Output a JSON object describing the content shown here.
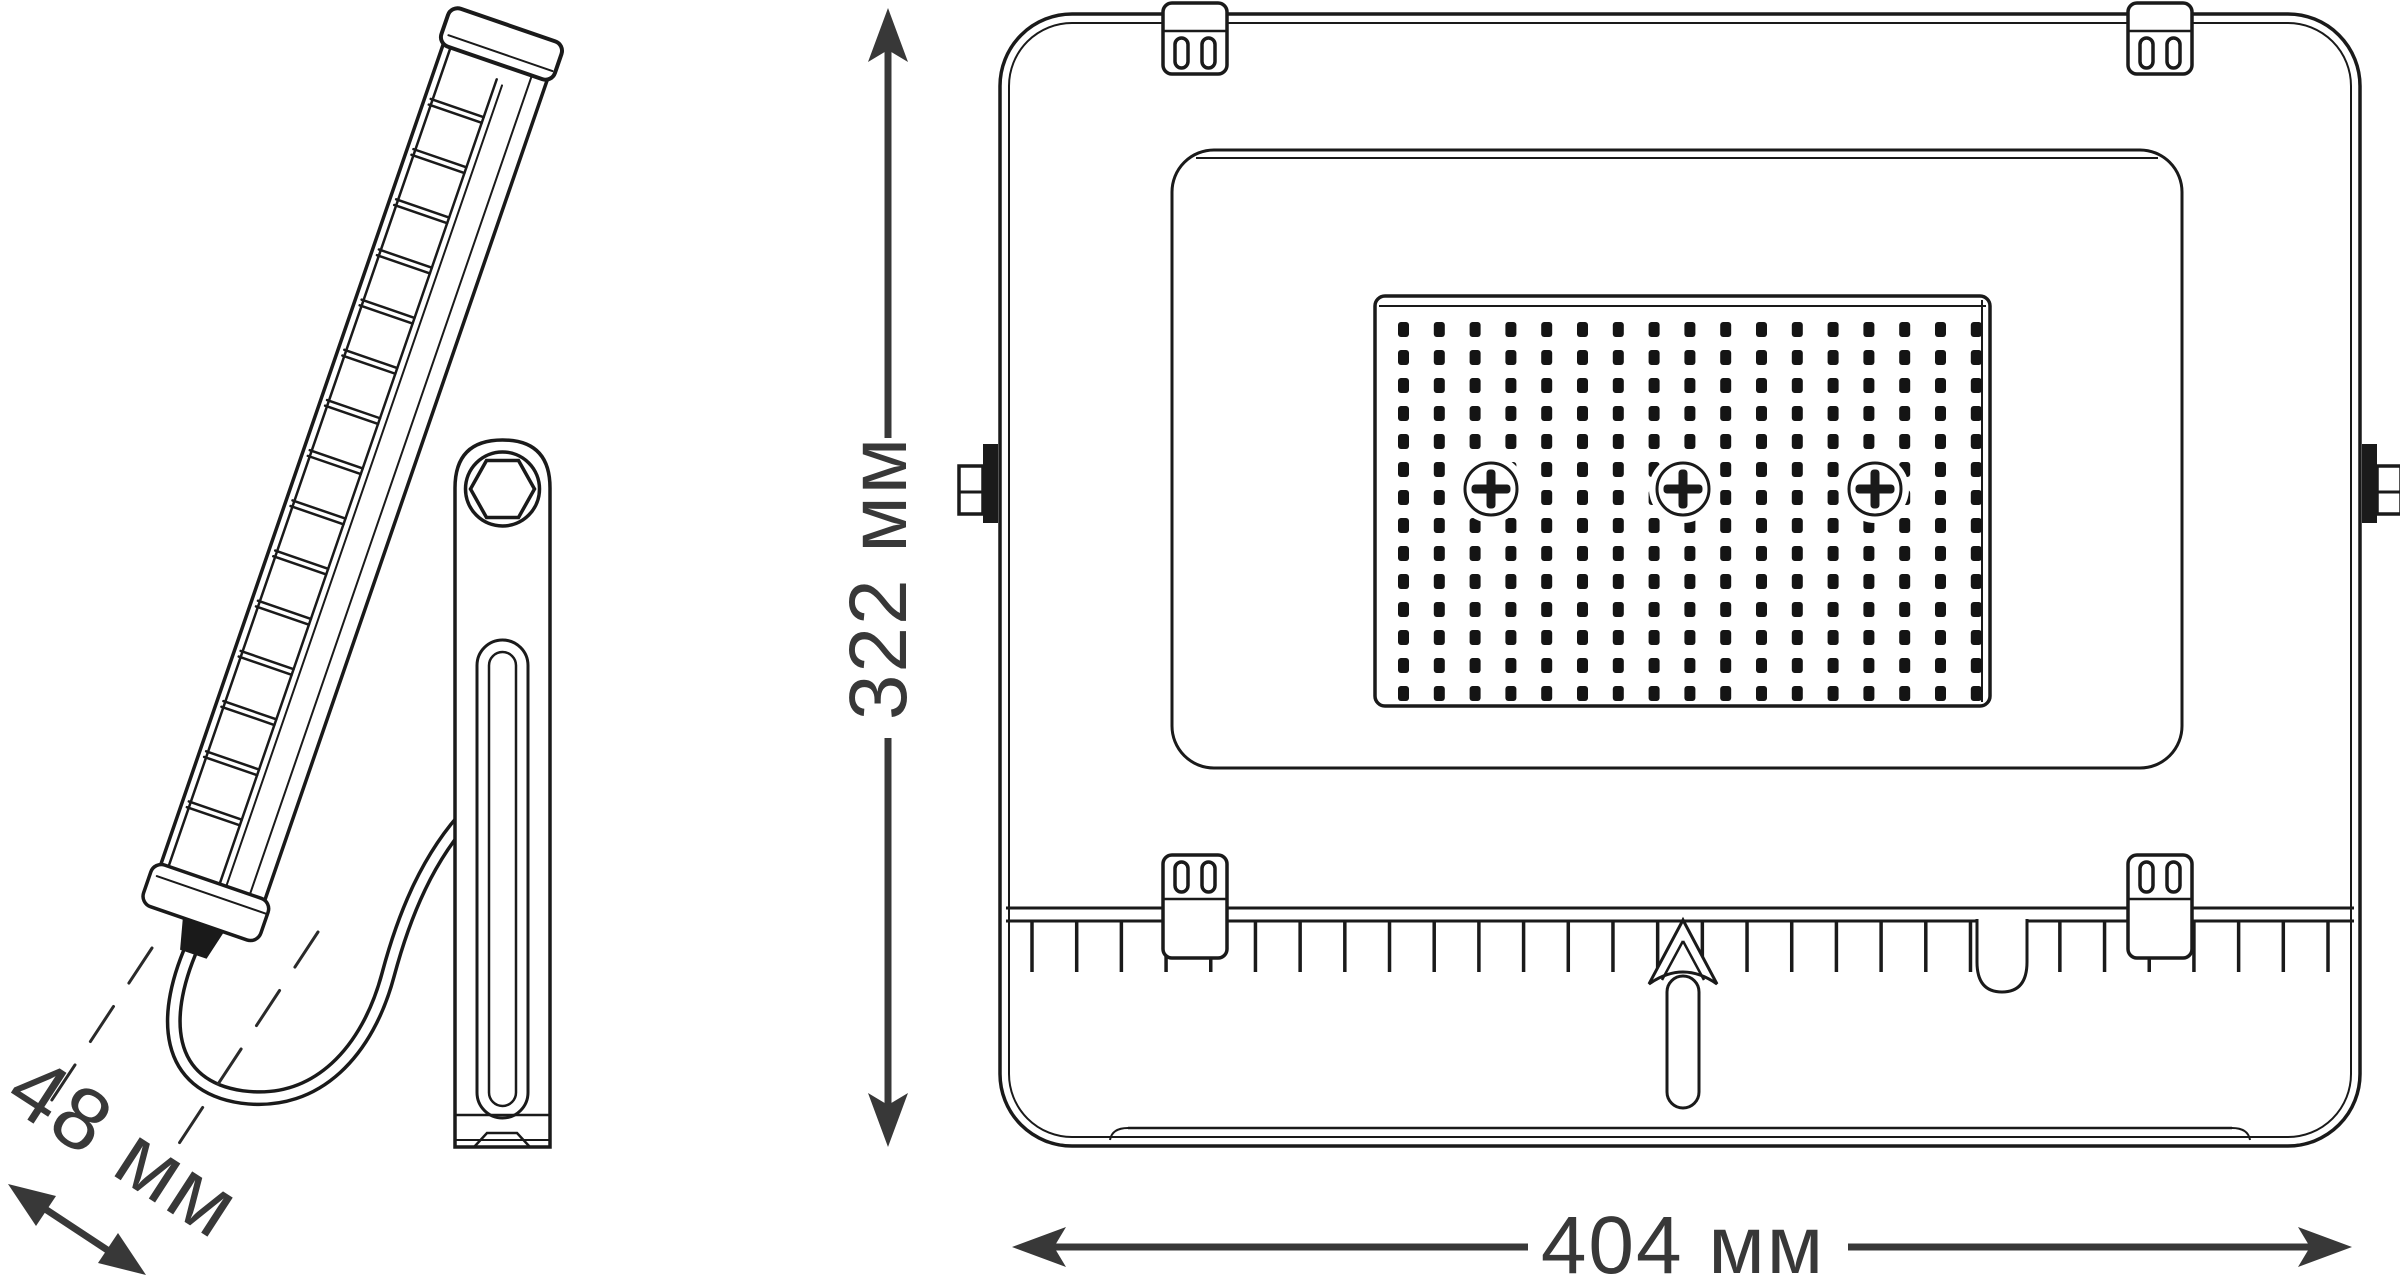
{
  "title": "LED floodlight dimensional drawing",
  "dimensions": {
    "depth": {
      "value": 48,
      "unit": "мм",
      "label": "48 мм"
    },
    "height": {
      "value": 322,
      "unit": "мм",
      "label": "322 мм"
    },
    "width": {
      "value": 404,
      "unit": "мм",
      "label": "404 мм"
    }
  },
  "views": {
    "side": {
      "name": "side view",
      "parts": [
        "heatsink-fins",
        "mounting-bracket",
        "hex-bolt",
        "adjustment-slot",
        "power-cable",
        "cable-gland"
      ]
    },
    "front": {
      "name": "front view",
      "parts": [
        "housing",
        "face-plate",
        "led-panel",
        "mounting-clips",
        "trunnion-pivots",
        "cooling-fins",
        "hanging-pin",
        "phillips-screws"
      ]
    }
  },
  "drawing": {
    "colors": {
      "line": "#1a1a1a",
      "dim": "#383838",
      "led": "#141414",
      "bg": "#ffffff"
    },
    "led_grid": {
      "cols": 17,
      "rows": 14,
      "x0": 1398,
      "y0": 322,
      "pitch_x": 35.8,
      "pitch_y": 28,
      "dot_w": 11,
      "dot_h": 15,
      "radius": 3
    },
    "fin_ticks": {
      "count": 30,
      "x0": 1032,
      "x1": 2328,
      "y0": 921,
      "y1": 972
    },
    "side_fins": {
      "count": 15,
      "y0": 92,
      "y1": 835,
      "x0": 6,
      "x1": 62,
      "gap": 6
    },
    "screws": {
      "count": 3,
      "centers_x": [
        1491,
        1683,
        1875
      ],
      "center_y": 489
    },
    "clips": {
      "count": 4,
      "top_centers_x": [
        1195,
        2160
      ],
      "bottom_centers_x": [
        1195,
        2160
      ]
    }
  }
}
